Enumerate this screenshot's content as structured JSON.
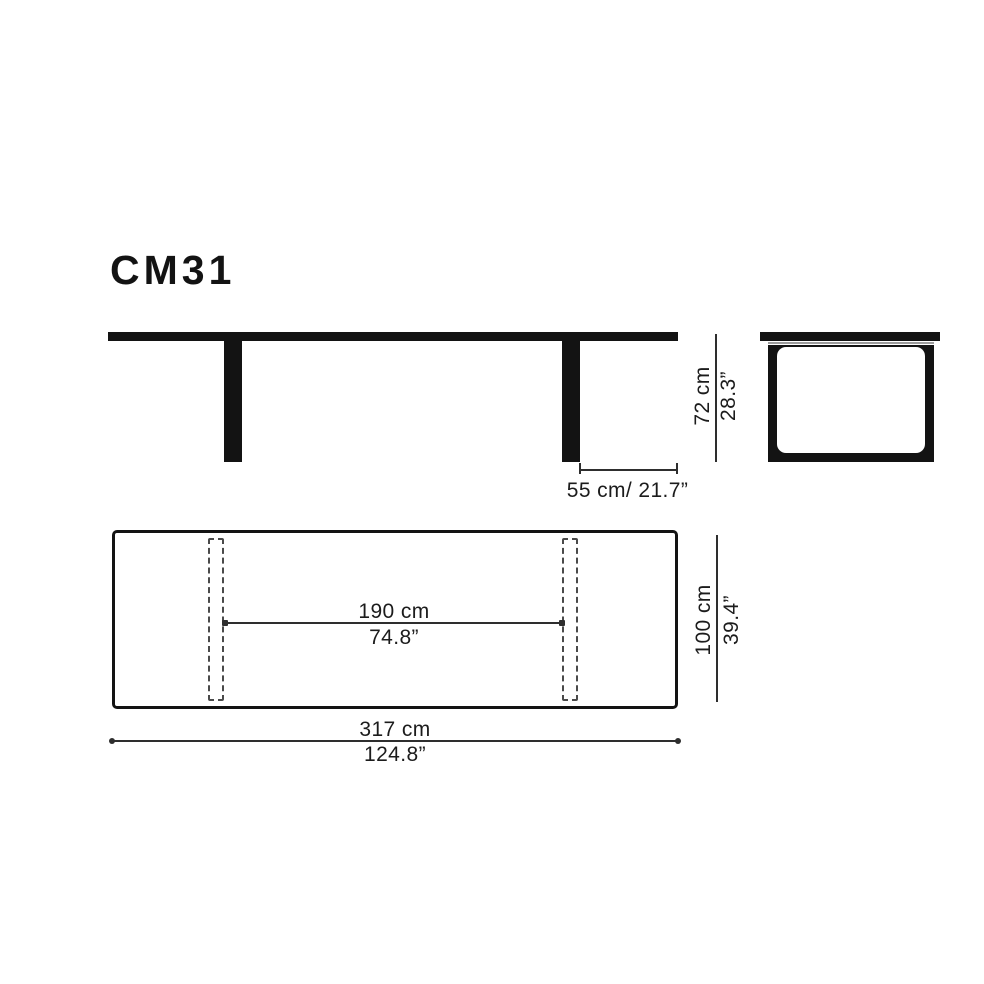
{
  "product": {
    "model": "CM31"
  },
  "dimensions": {
    "height": {
      "metric": "72 cm",
      "imperial": "28.3”"
    },
    "overhang": {
      "combined": "55 cm/ 21.7”"
    },
    "leg_span": {
      "metric": "190 cm",
      "imperial": "74.8”"
    },
    "width": {
      "metric": "100 cm",
      "imperial": "39.4”"
    },
    "length": {
      "metric": "317 cm",
      "imperial": "124.8”"
    }
  },
  "colors": {
    "ink": "#131313",
    "dim_line": "#2e2e2e",
    "dashed": "#4a4a4a",
    "shadow": "#9c9c9c",
    "background": "#ffffff"
  }
}
